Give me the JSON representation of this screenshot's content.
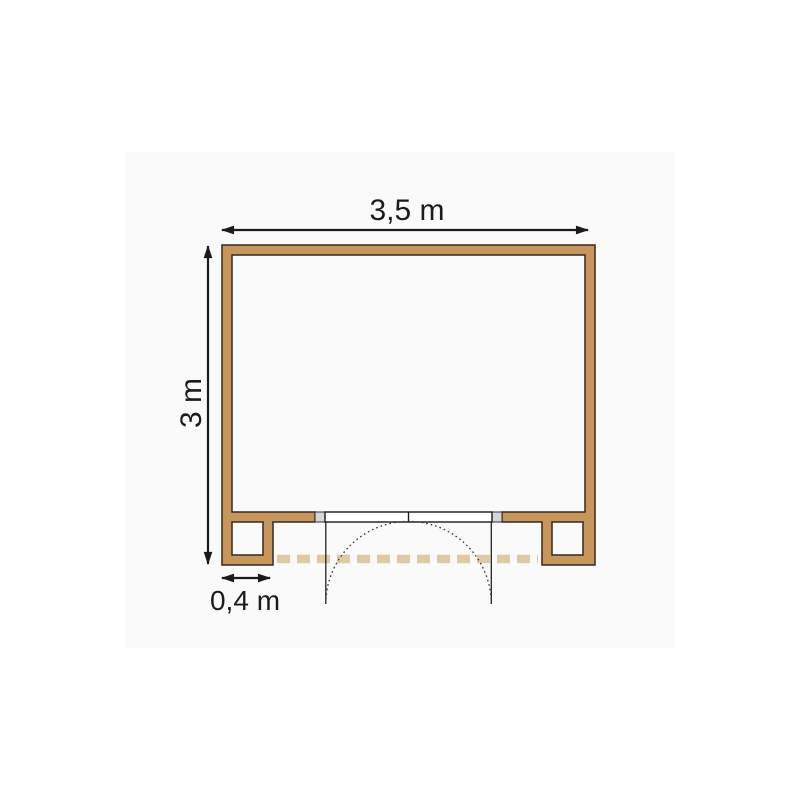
{
  "page": {
    "background_color": "#ffffff"
  },
  "diagram": {
    "name": "shed-floor-plan-top-view",
    "background_color": "#fafafa",
    "labels": {
      "width": "3,5 m",
      "depth": "3 m",
      "post_width": "0,4 m"
    },
    "colors": {
      "wall_fill": "#c6965c",
      "wall_outline": "#36281b",
      "threshold_dash": "#decaa5",
      "door_jamb_fill": "#d6d6d6",
      "door_leaf_fill": "#ffffff",
      "door_line": "#222222",
      "dimension_line": "#1b1b1b"
    }
  }
}
